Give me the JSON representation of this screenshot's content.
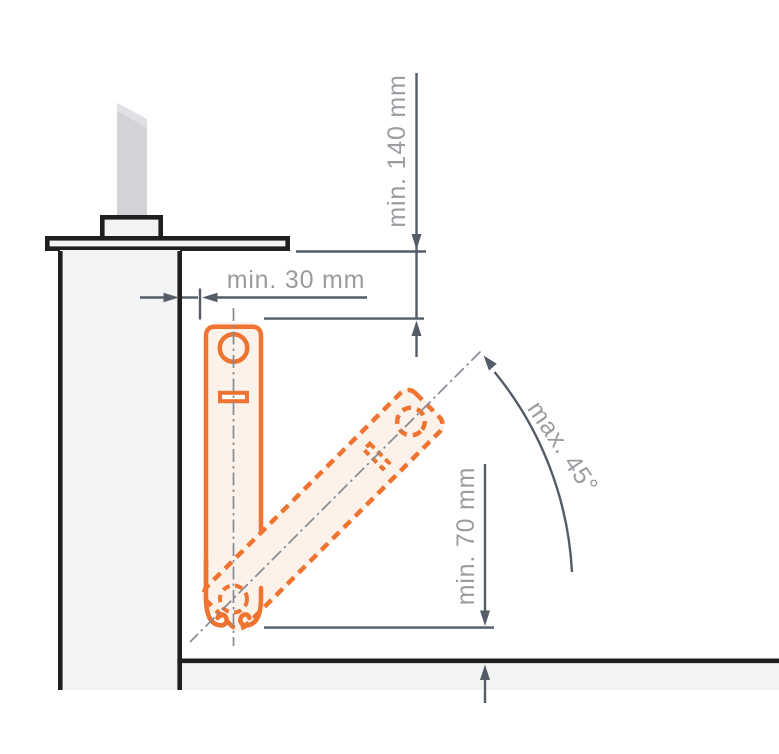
{
  "diagram": {
    "dimensions": {
      "top": {
        "label": "min. 140 mm"
      },
      "side": {
        "label": "min. 30 mm"
      },
      "bottom": {
        "label": "min. 70 mm"
      },
      "angle": {
        "label": "max. 45°"
      }
    },
    "colors": {
      "bracket_orange": "#ef7432",
      "bracket_fill": "#fdf2e9",
      "slot_fill": "#fffdfb",
      "dimension_line": "#545c68",
      "label_gray": "#9b9ca1",
      "outline_black": "#1f1f1d",
      "structure_fill": "#f2f3f3",
      "blade_gray": "#d2d3d6",
      "blade_highlight": "#dfe0e3",
      "centerline_gray": "#868b92"
    }
  }
}
